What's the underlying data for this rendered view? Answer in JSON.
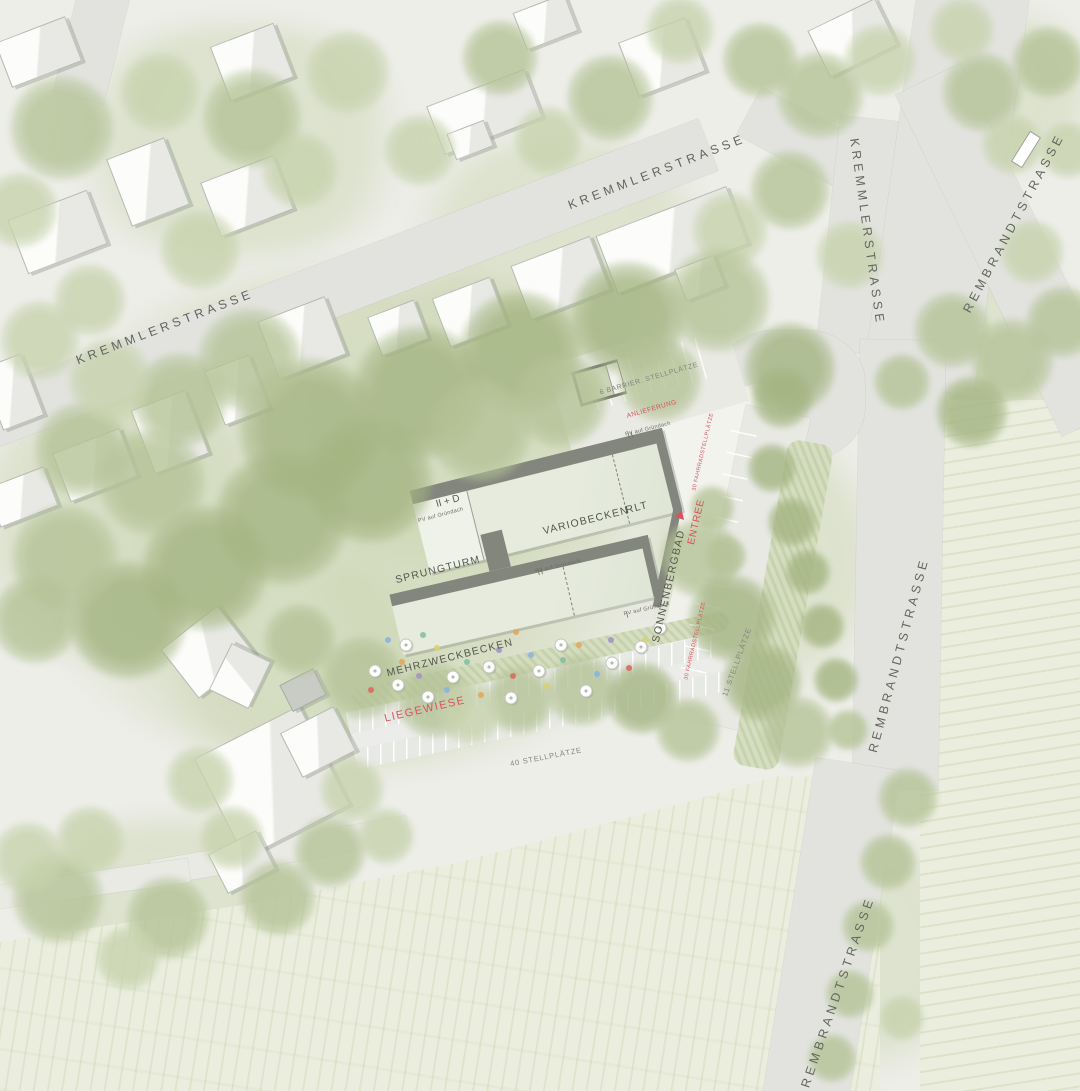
{
  "plan": {
    "streets": {
      "kremmler_nw": "KREMMLERSTRASSE",
      "kremmler_top": "KREMMLERSTRASSE",
      "kremmler_east_leg": "KREMMLERSTRASSE",
      "rembrandt_ne": "REMBRANDTSTRASSE",
      "rembrandt_east": "REMBRANDTSTRASSE",
      "rembrandt_south": "REMBRANDTSTRASSE"
    },
    "site": {
      "facility_name": "SONNENBERGBAD",
      "entrance_label": "ENTREE",
      "upper_hall": {
        "floors_label": "II + D",
        "pv_label_left": "PV auf Gründach",
        "pv_label_right": "PV auf Gründach",
        "pv_floors_right": "II",
        "pool_label": "VARIOBECKEN",
        "hvac_label": "RLT",
        "tower_label": "SPRUNGTURM"
      },
      "lower_hall": {
        "pv_label_top": "PV auf Gründach",
        "pv_floors_top": "II",
        "pv_label_right": "PV auf Gründach",
        "pv_floors_right": "I",
        "pool_label": "MEHRZWECKBECKEN"
      },
      "lawn_label": "LIEGEWIESE"
    },
    "parking": {
      "car_main": "40 STELLPLÄTZE",
      "car_drive": "11 STELLPLÄTZE",
      "accessible": "6 BARRIER. STELLPLÄTZE",
      "delivery": "ANLIEFERUNG",
      "bike_north": "30 FAHRRADSTELLPLÄTZE",
      "bike_south": "30 FAHRRADSTELLPLÄTZE"
    },
    "colors": {
      "paper": "#edeee8",
      "street": "#e2e3de",
      "vegetation": "#b7c49c",
      "field": "#ebeedf",
      "building": "#f7f7f4",
      "roof_green": "#e2e8d8",
      "wall_dark": "#83867d",
      "label_gray": "#5d6057",
      "accent_red": "#d8525f"
    }
  }
}
